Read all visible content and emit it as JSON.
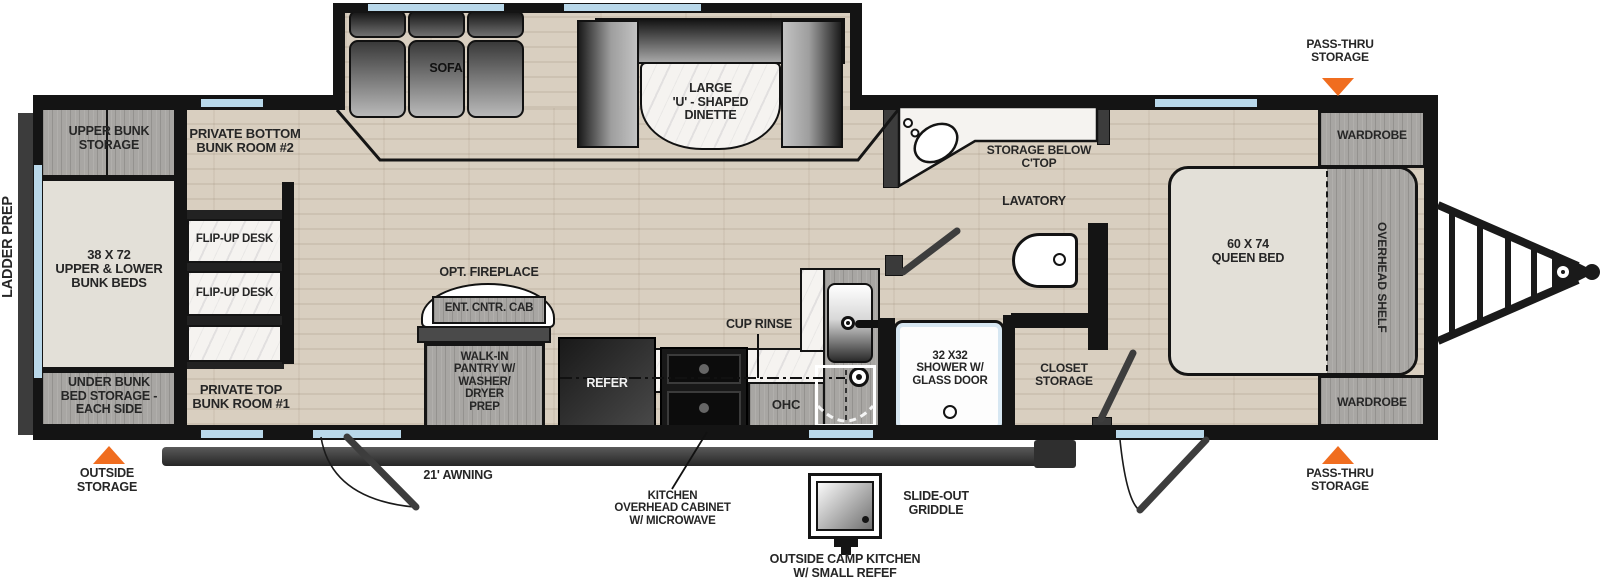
{
  "plan": {
    "exterior": {
      "ladder_prep": "LADDER PREP",
      "outside_storage": "OUTSIDE\nSTORAGE",
      "pass_thru_storage_front": "PASS-THRU\nSTORAGE",
      "pass_thru_storage_rear": "PASS-THRU\nSTORAGE",
      "awning": "21' AWNING",
      "slide_out_griddle": "SLIDE-OUT\nGRIDDLE",
      "outside_camp_kitchen": "OUTSIDE CAMP KITCHEN\nW/ SMALL REFEF",
      "kitchen_overhead_cabinet": "KITCHEN\nOVERHEAD CABINET\nW/ MICROWAVE"
    },
    "bunkhouse": {
      "upper_bunk_storage": "UPPER BUNK\nSTORAGE",
      "bunk_beds": "38 X 72\nUPPER & LOWER\nBUNK BEDS",
      "under_bunk_storage": "UNDER BUNK\nBED STORAGE -\nEACH SIDE",
      "bottom_bunk_room": "PRIVATE BOTTOM\nBUNK ROOM #2",
      "top_bunk_room": "PRIVATE TOP\nBUNK ROOM #1",
      "flip_up_desk_upper": "FLIP-UP DESK",
      "flip_up_desk_lower": "FLIP-UP DESK"
    },
    "living": {
      "sofa": "SOFA",
      "dinette": "LARGE\n'U' - SHAPED\nDINETTE",
      "opt_fireplace": "OPT. FIREPLACE",
      "ent_cntr_cab": "ENT. CNTR. CAB",
      "walk_in_pantry": "WALK-IN\nPANTRY W/\nWASHER/\nDRYER\nPREP"
    },
    "kitchen": {
      "refer": "REFER",
      "cup_rinse": "CUP RINSE",
      "ohc": "OHC"
    },
    "bath": {
      "storage_below_ctop": "STORAGE BELOW\nC'TOP",
      "lavatory": "LAVATORY",
      "shower": "32 X32\nSHOWER W/\nGLASS DOOR",
      "closet_storage": "CLOSET\nSTORAGE"
    },
    "bedroom": {
      "queen_bed": "60 X 74\nQUEEN BED",
      "overhead_shelf": "OVERHEAD SHELF",
      "wardrobe_front": "WARDROBE",
      "wardrobe_rear": "WARDROBE"
    }
  },
  "colors": {
    "wall": "#141414",
    "floor_wood": "#d9cfc0",
    "cabinet_gray": "#a8a6a3",
    "marble": "#f5f3f0",
    "mattress": "#e3e0d8",
    "window_blue": "#b9d8ea",
    "accent_orange": "#f06d1f",
    "label_text": "#262626"
  }
}
